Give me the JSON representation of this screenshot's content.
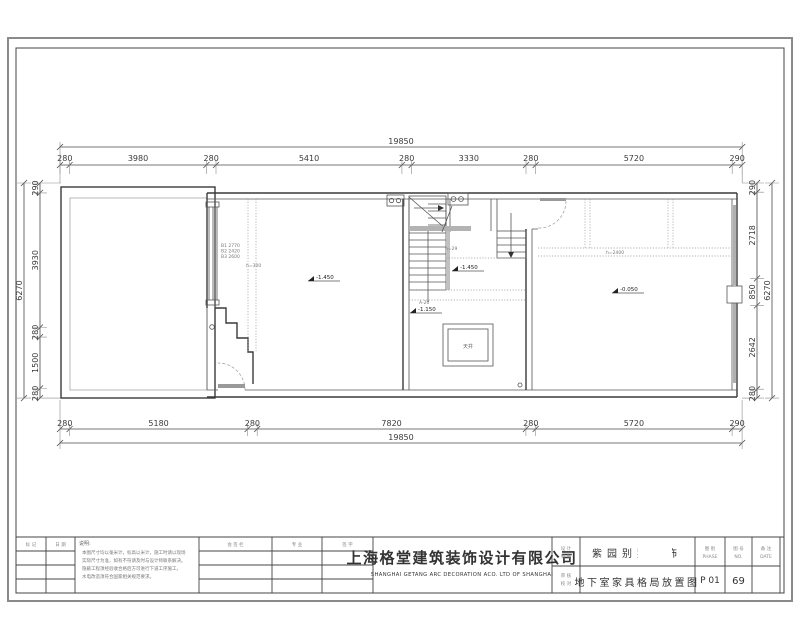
{
  "dims": {
    "top_total": "19850",
    "top_segments": [
      "280",
      "3980",
      "280",
      "5410",
      "280",
      "3330",
      "280",
      "5720",
      "290"
    ],
    "bottom_total": "19850",
    "bottom_segments": [
      "280",
      "5180",
      "280",
      "7820",
      "280",
      "5720",
      "290"
    ],
    "left_total": "6270",
    "left_segments": [
      "290",
      "3930",
      "280",
      "1500",
      "280"
    ],
    "right_total": "6270",
    "right_segments": [
      "290",
      "2718",
      "850",
      "2642",
      "280"
    ]
  },
  "plan": {
    "lightwell": "天井",
    "elev_left": "-1.450",
    "elev_stair": "-1.450",
    "elev_well": "-1.150",
    "elev_right": "-0.050",
    "stair_note": "A-20",
    "stair_count": "h=29",
    "left_note1": "B1 2770",
    "left_note2": "B2 2420",
    "left_note3": "B3 2600",
    "left_note4": "h=300",
    "right_note": "h=2400"
  },
  "title_block": {
    "rev_col1": "标 记",
    "rev_col2": "日 期",
    "notes_title": "说明:",
    "notes_line1": "本图尺寸均以毫米计，标高以米计，施工时请以现场",
    "notes_line2": "实际尺寸为准，如有不符请及时与设计师联系解决。",
    "notes_line3": "隐蔽工程须经验收合格后方可进行下道工序施工，",
    "notes_line4": "水电改造须符合国家相关规范要求。",
    "mid_header": "会 签 栏",
    "mid_col1": "专 业",
    "mid_col2": "签 字",
    "company_cn": "上海格堂建筑装饰设计有限公司",
    "company_en": "SHANGHAI GETANG ARC DECORATION ACO. LTD OF SHANGHAI",
    "role_a1": "设 计",
    "role_a2": "制 图",
    "role_b1": "审 核",
    "role_b2": "校 对",
    "project_name": "紫园别墅装饰",
    "drawing_title": "地下室家具格局放置图",
    "col_sheet_label1": "图 别",
    "col_sheet_label2": "PHASE",
    "col_page_label1": "图 号",
    "col_page_label2": "NO.",
    "col_date_label1": "备 注",
    "col_date_label2": "DATE",
    "sheet_no": "P 01",
    "page_no": "69"
  },
  "colors": {
    "teal": "#4e7f8e",
    "gray_value": "#7f8f96",
    "line": "#3a3a3a"
  }
}
